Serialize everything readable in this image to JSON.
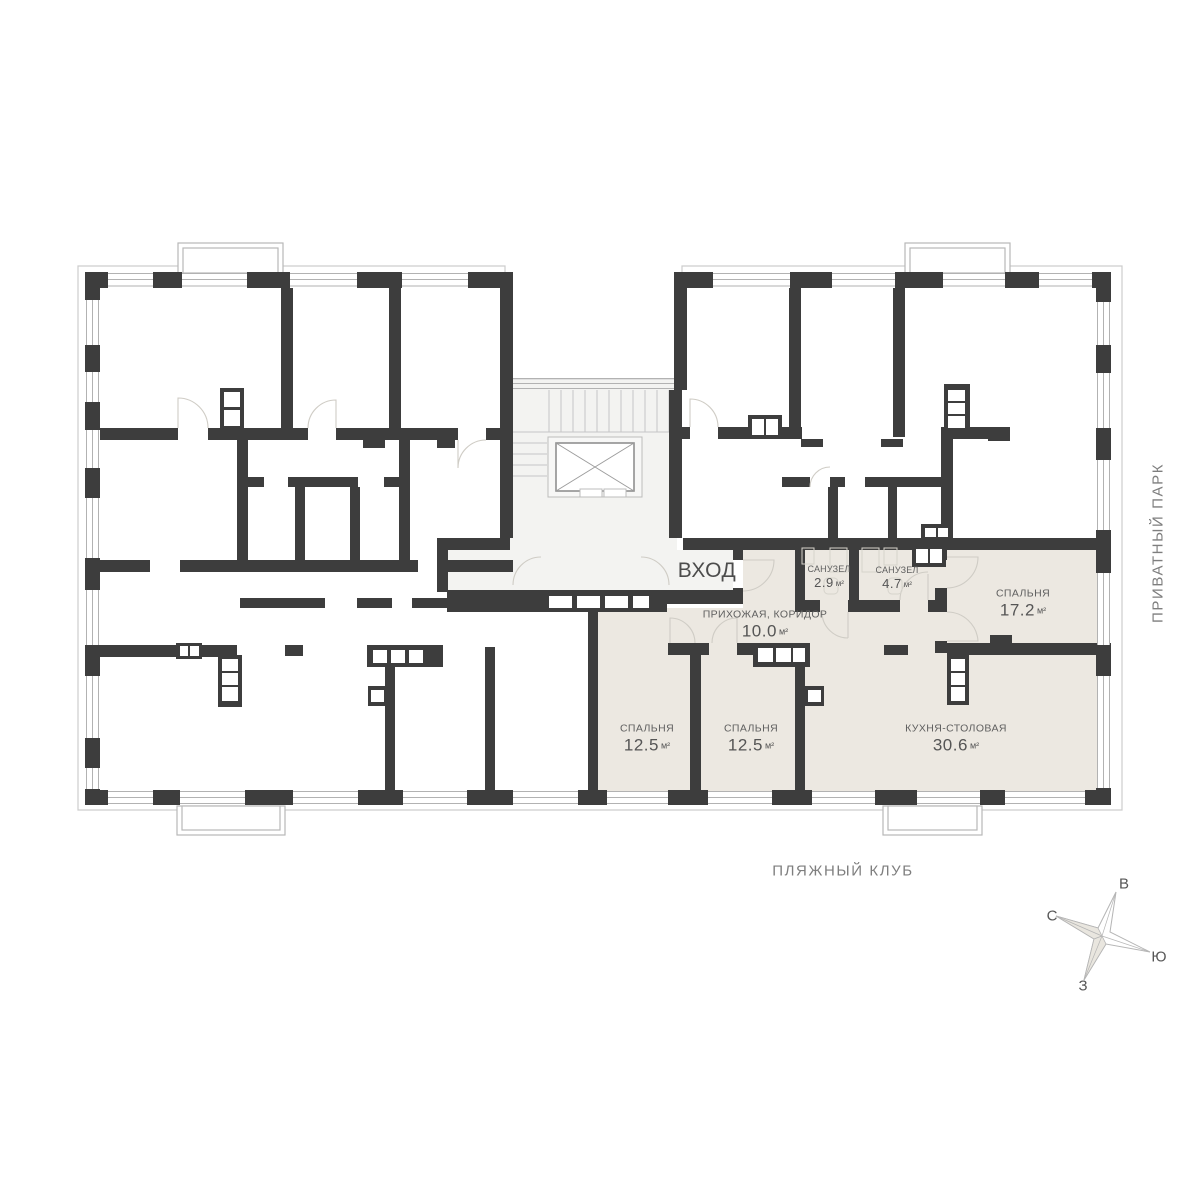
{
  "legend": {
    "entrance": "ВХОД",
    "park": "ПРИВАТНЫЙ ПАРК",
    "beach_club": "ПЛЯЖНЫЙ КЛУБ"
  },
  "compass": {
    "north": "С",
    "east": "В",
    "south": "Ю",
    "west": "З"
  },
  "rooms": {
    "hallway": {
      "name": "ПРИХОЖАЯ, КОРИДОР",
      "area": "10.0",
      "unit": "м²"
    },
    "bathroom_small": {
      "name": "САНУЗЕЛ",
      "area": "2.9",
      "unit": "м²"
    },
    "bathroom_large": {
      "name": "САНУЗЕЛ",
      "area": "4.7",
      "unit": "м²"
    },
    "bedroom_right": {
      "name": "СПАЛЬНЯ",
      "area": "17.2",
      "unit": "м²"
    },
    "bedroom_left": {
      "name": "СПАЛЬНЯ",
      "area": "12.5",
      "unit": "м²"
    },
    "bedroom_middle": {
      "name": "СПАЛЬНЯ",
      "area": "12.5",
      "unit": "м²"
    },
    "kitchen": {
      "name": "КУХНЯ-СТОЛОВАЯ",
      "area": "30.6",
      "unit": "м²"
    }
  },
  "colors": {
    "wall": "#3d3d3d",
    "apartment_fill": "#ece8e1",
    "core_fill": "#f3f3f1",
    "thin_line": "#bcbcbc"
  }
}
